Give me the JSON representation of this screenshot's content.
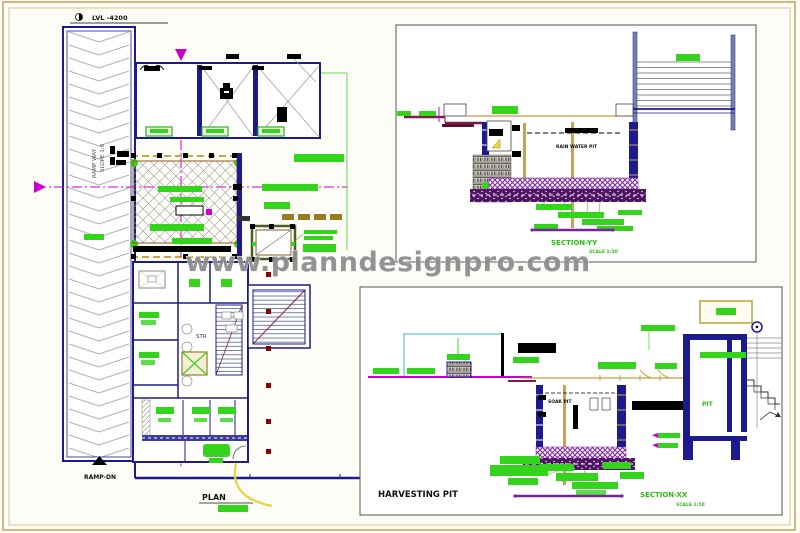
{
  "watermark": {
    "text": "www.planndesignpro.com"
  },
  "sheet": {
    "plan": {
      "title": "PLAN",
      "level_label": "LVL -4200",
      "ramp_line1": "RAMP WAY",
      "ramp_line2": "SLOPE 1:8",
      "ramp_dn_label": "RAMP-DN",
      "stair_label": "STR"
    },
    "section_yy": {
      "title": "SECTION-YY",
      "scale_label": "SCALE 1:50",
      "pit_label": "RAIN WATER PIT"
    },
    "section_xx": {
      "heading": "HARVESTING PIT",
      "title": "SECTION-XX",
      "scale_label": "SCALE 1:50",
      "pit_label": "SOAK PIT",
      "room_label": "PIT"
    },
    "colors": {
      "label_green": "#35d41c",
      "wall_navy": "#1b1b8f",
      "section_magenta": "#cc00cc",
      "drain_tan": "#b8860b",
      "slab_purple": "#7d1fa0",
      "ground_maroon": "#7a2048",
      "turning_yellow": "#e6d53c",
      "pipe_cyan": "#3ab5c9",
      "frame_tan": "#c9a863"
    }
  }
}
